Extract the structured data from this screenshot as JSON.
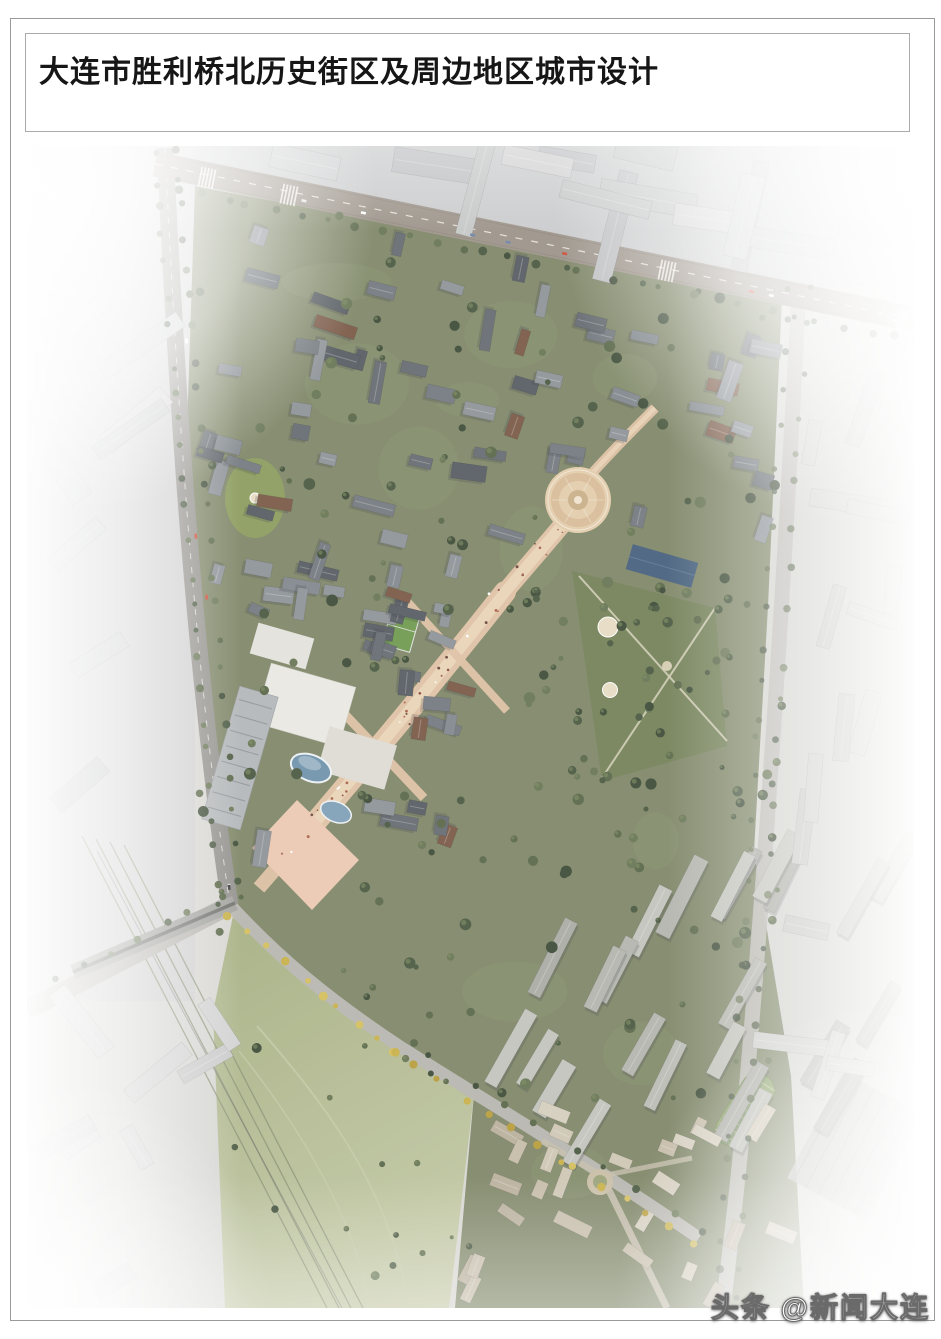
{
  "header": {
    "title": "大连市胜利桥北历史街区及周边地区城市设计"
  },
  "figure": {
    "kind": "aerial-masterplan-rendering",
    "subject": "Shengli Bridge North historic district bird's-eye urban design rendering",
    "watermark": {
      "text": "头条 @新闻大连"
    },
    "palette": {
      "paper": "#ffffff",
      "frame_border": "#9a9a9a",
      "title_box_border": "#ababab",
      "title_text": "#161616",
      "base": "#d8d7d3",
      "context_block_colors": [
        "#c6c7c9",
        "#cdced0",
        "#c0c1c4",
        "#d3d3d5"
      ],
      "district_green": "#7f8769",
      "park_green": "#74825a",
      "field_green": "#a9b287",
      "field_green_light": "#c6cba9",
      "pitch_green": "#6f9a50",
      "road": "#b2b0ac",
      "left_road": "#94928e",
      "arterial_road": "#9d948b",
      "road_marking": "#f5f3ee",
      "rail_dark": "#6f6f6d",
      "rail_line": "#8b9377",
      "bridge_gray": "#a2a2a0",
      "spine_tan": "#e0c2a6",
      "spine_light": "#eed9bd",
      "plaza_ring": "#d9bd99",
      "plaza_ring_light": "#e4ceae",
      "pink_plaza": "#ecc9b4",
      "mall_white": "#eae9e5",
      "mall_secondary": "#dedcd6",
      "tower_slab": "#b4b7bb",
      "glass_blue": "#6f93ad",
      "glass_blue_light": "#7fa0b8",
      "blue_roof": "#46607e",
      "greenhouse": "#8aa06a",
      "roof_colors": [
        "#666c73",
        "#747a80",
        "#82888e",
        "#575d64",
        "#8f949a",
        "#7b5a49"
      ],
      "residential_colors": [
        "#b4b5af",
        "#bcbdb7",
        "#abaca6",
        "#c3c4be"
      ],
      "village_colors": [
        "#c6bdab",
        "#cfc7b6",
        "#bab09e",
        "#d6cfc0"
      ],
      "tree_colors": [
        "#3e4c38",
        "#4b5a42",
        "#5a684a",
        "#687655"
      ],
      "tree_highlight": "#7c8a60",
      "autumn_tree_colors": [
        "#c9b14a",
        "#d6c05e",
        "#b89e3c"
      ],
      "people_dot_colors": [
        "#a8654d",
        "#8a4a3a",
        "#ffffff",
        "#6b4a3e"
      ],
      "car_colors": [
        "#ffffff",
        "#e8e8e8",
        "#cf4b38",
        "#3c3c42",
        "#6f86a8"
      ],
      "shadow": "#3a4148",
      "fog": "#ffffff",
      "watermark_text": "#ffffff",
      "watermark_outline": "#6a6a6a"
    }
  }
}
